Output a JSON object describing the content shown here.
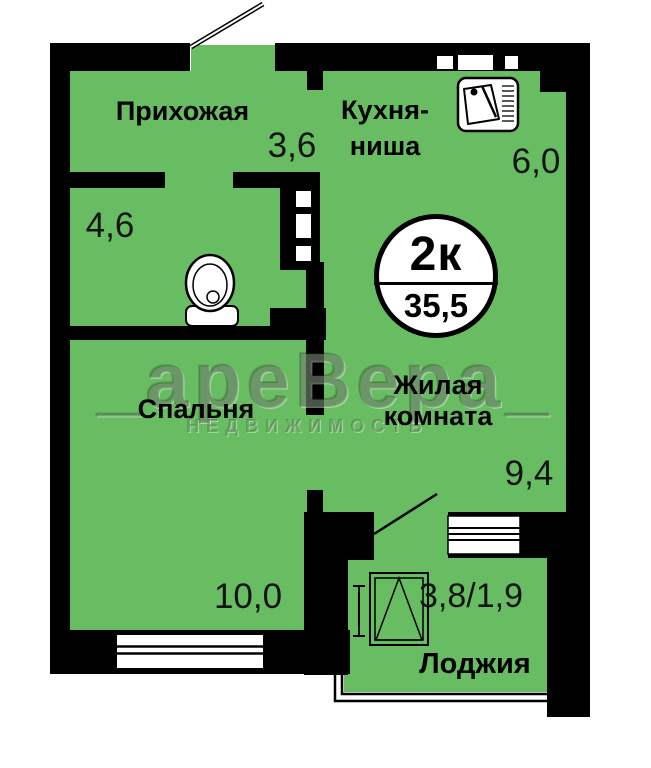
{
  "plan": {
    "badge": {
      "type": "2к",
      "area": "35,5"
    },
    "rooms": {
      "hallway": {
        "name": "Прихожая",
        "area": "3,6"
      },
      "bathroom": {
        "area": "4,6"
      },
      "kitchen": {
        "name_line1": "Кухня-",
        "name_line2": "ниша",
        "area": "6,0"
      },
      "bedroom": {
        "name": "Спальня",
        "area": "10,0"
      },
      "living": {
        "name_line1": "Жилая",
        "name_line2": "комната",
        "area": "9,4"
      },
      "loggia": {
        "name": "Лоджия",
        "area": "3,8/1,9"
      }
    },
    "watermark": {
      "brand": "_ареВера_",
      "subtitle": "НЕДВИЖИМОСТЬ"
    },
    "icons": {
      "toilet": "toilet-icon",
      "sink": "kitchen-sink-icon",
      "window": "casement-window-icon",
      "door_swing": "door-swing-icon"
    },
    "colors": {
      "room_fill": "#68bc62",
      "wall": "#000000",
      "background": "#ffffff"
    }
  }
}
